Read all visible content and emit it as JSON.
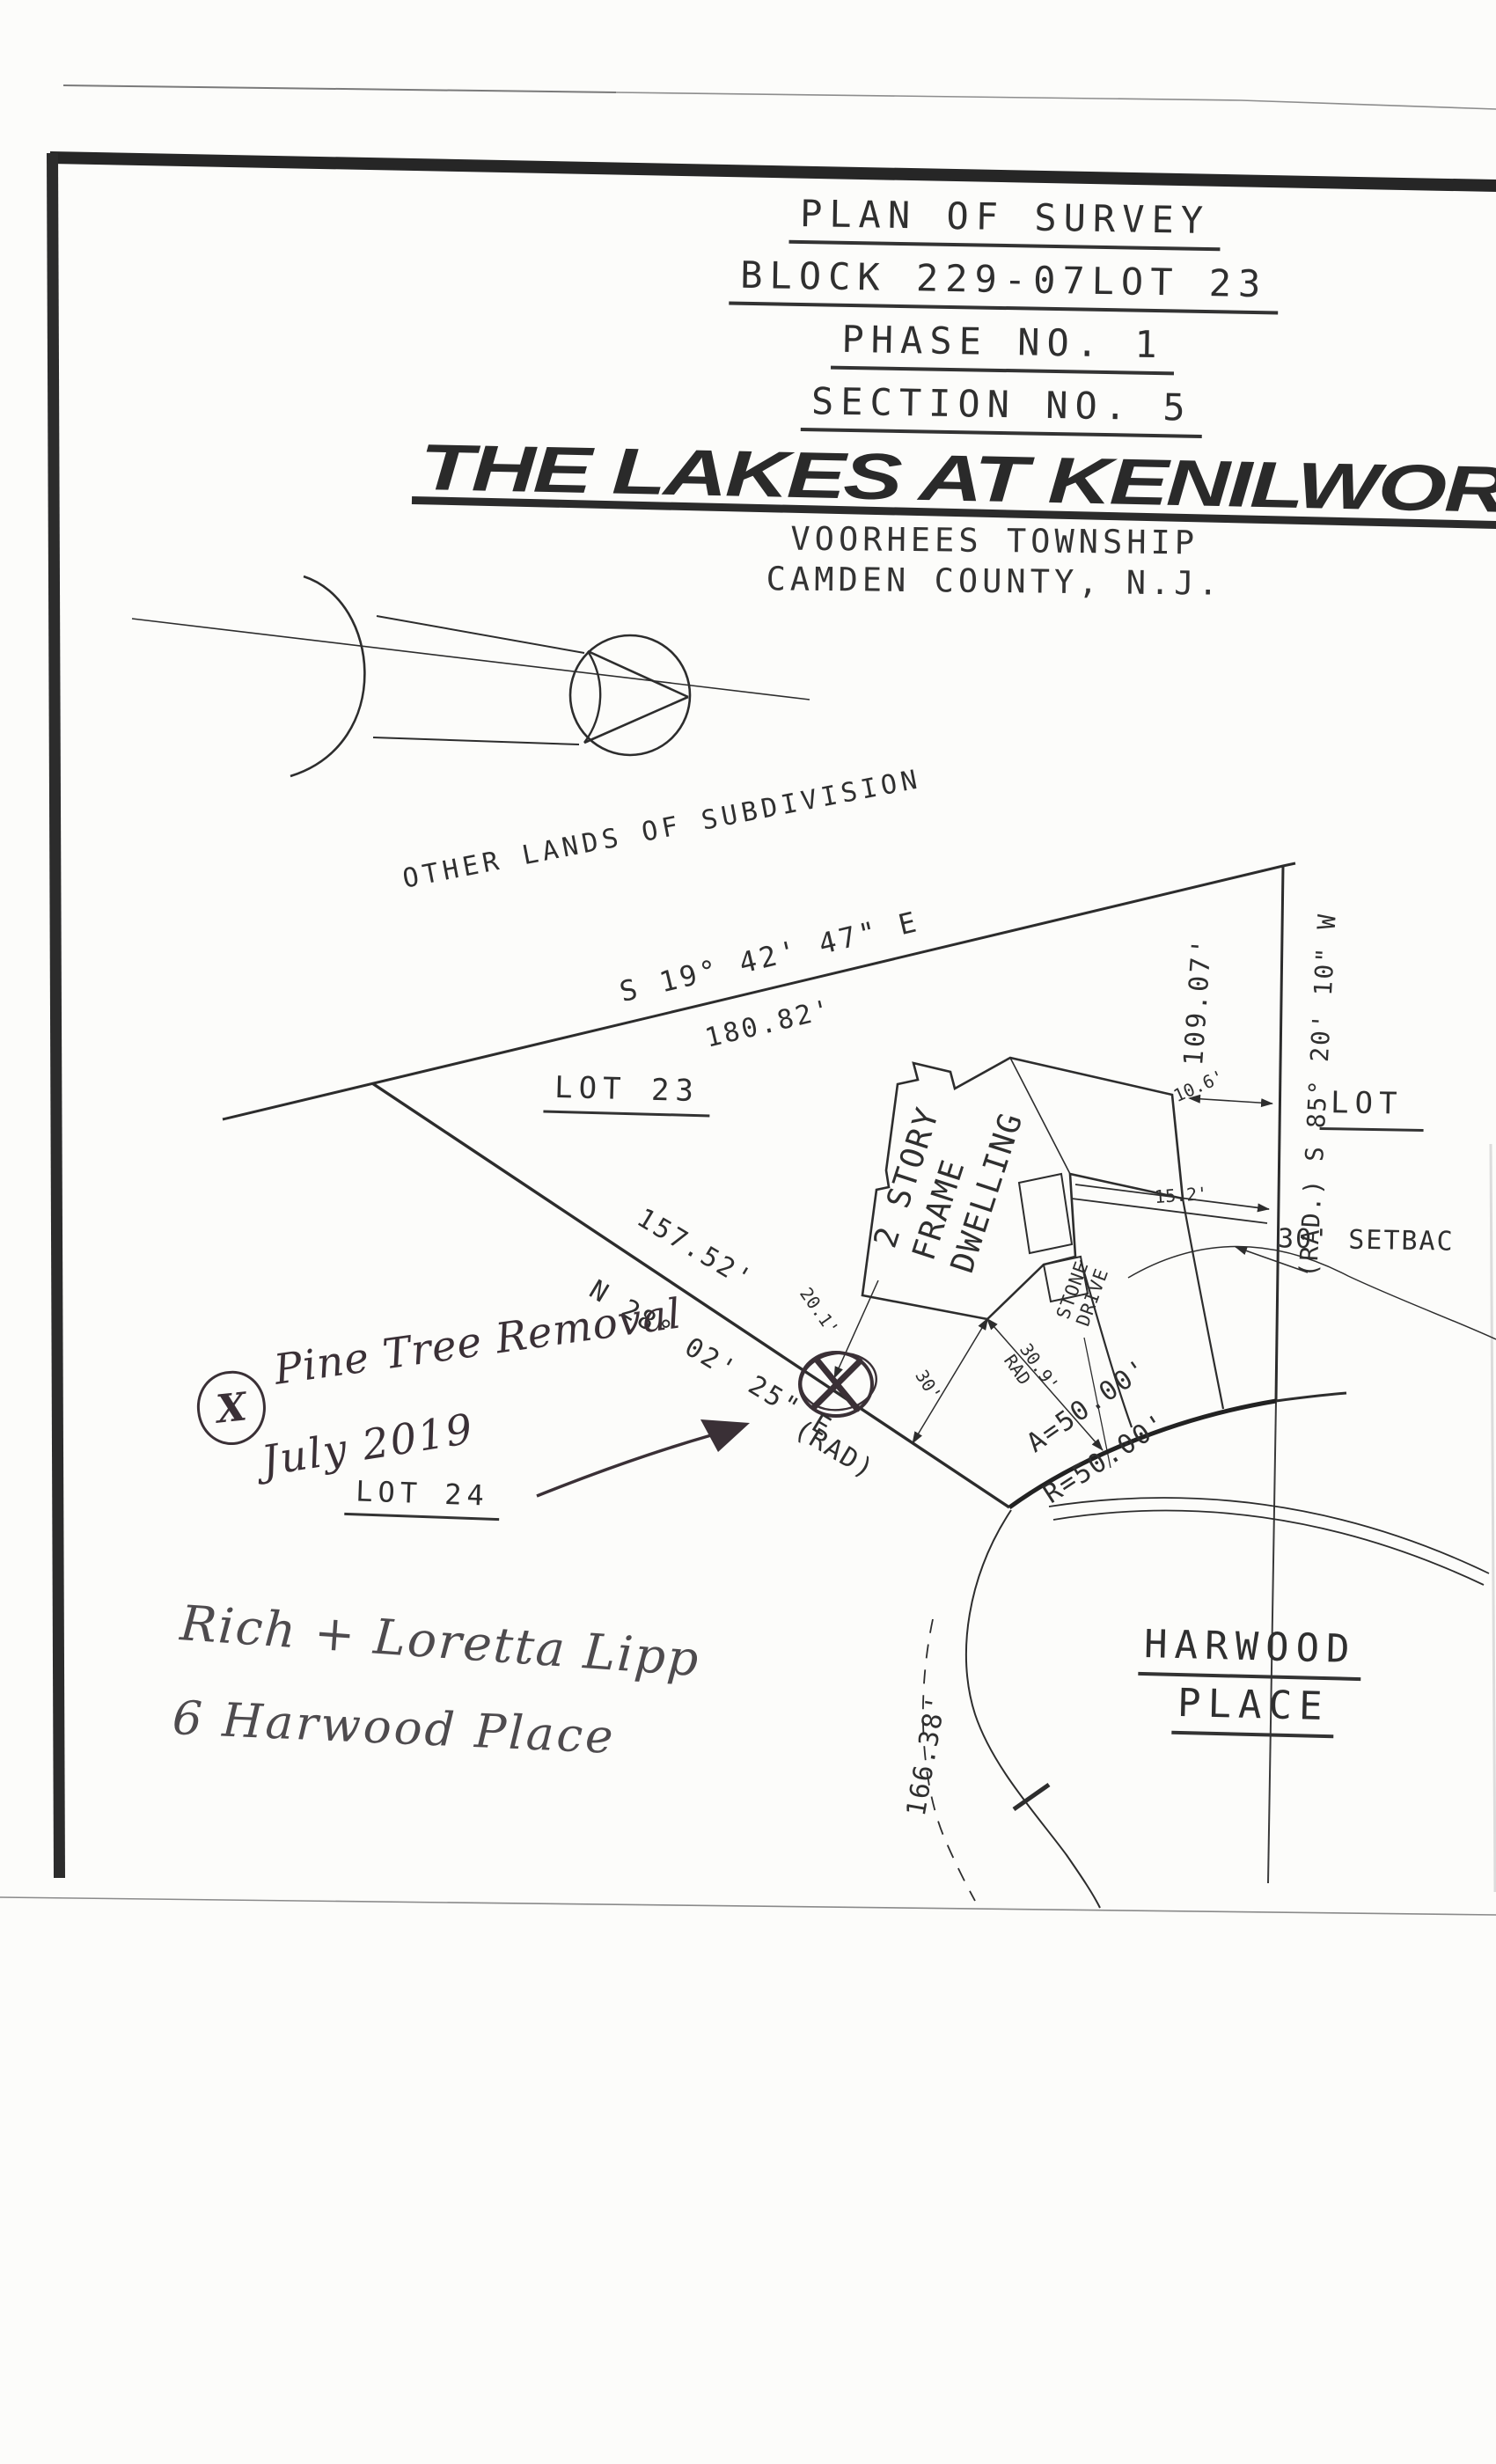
{
  "title_block": {
    "l1": "PLAN OF SURVEY",
    "l2": "BLOCK 229-07LOT 23",
    "l3": "PHASE NO. 1",
    "l4": "SECTION NO. 5"
  },
  "heading": {
    "name": "THE LAKES AT KENILWORT",
    "township": "VOORHEES TOWNSHIP",
    "county": "CAMDEN COUNTY, N.J."
  },
  "plat": {
    "other_lands": "OTHER LANDS OF SUBDIVISION",
    "nw_bearing": "S 19° 42' 47\" E",
    "nw_distance": "180.82'",
    "east_distance": "109.07'",
    "east_bearing": "(RAD.) S 85° 20' 10\" W",
    "sw_distance": "157.52'",
    "sw_bearing": "N 28° 02' 25\" E",
    "sw_rad": "(RAD)",
    "lot23": "LOT 23",
    "lot24": "LOT 24",
    "lot_partial": "LOT",
    "house_l1": "2 STORY",
    "house_l2": "FRAME",
    "house_l3": "DWELLING",
    "drive_l1": "STONE",
    "drive_l2": "DRIVE",
    "dim_10_6": "10.6'",
    "dim_15_2": "15.2'",
    "dim_20_1": "20.1'",
    "dim_30": "30'",
    "dim_30_9": "30.9'",
    "dim_30_9_rad": "RAD",
    "arc_length_label": "A=50.00'",
    "radius_label": "R=50.00'",
    "arc_166": "166.38'",
    "setback": "30' SETBAC",
    "street_l1": "HARWOOD",
    "street_l2": "PLACE"
  },
  "annotations": {
    "legend_mark": "X",
    "note_l1": "Pine Tree Removal",
    "note_l2": "July 2019",
    "owner_l1": "Rich + Loretta Lipp",
    "owner_l2": "6 Harwood Place"
  }
}
